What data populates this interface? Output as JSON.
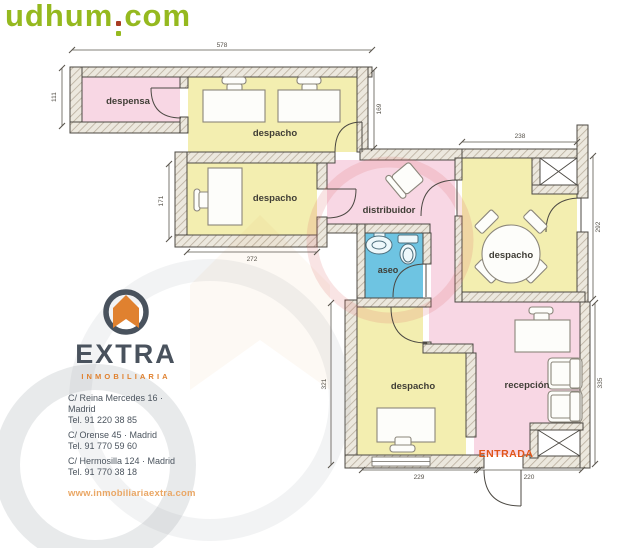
{
  "watermark": {
    "text_main": "udhum",
    "text_tld": "com"
  },
  "floorplan": {
    "rooms": [
      {
        "id": "despensa",
        "label": "despensa"
      },
      {
        "id": "despacho-top",
        "label": "despacho"
      },
      {
        "id": "despacho-mid",
        "label": "despacho"
      },
      {
        "id": "distribuidor",
        "label": "distribuidor"
      },
      {
        "id": "aseo",
        "label": "aseo"
      },
      {
        "id": "despacho-right",
        "label": "despacho"
      },
      {
        "id": "despacho-bottom",
        "label": "despacho"
      },
      {
        "id": "recepcion",
        "label": "recepción"
      }
    ],
    "entrance_label": "ENTRADA",
    "dimensions": {
      "top_width": "578",
      "despensa_height": "111",
      "despacho_top_height": "169",
      "despacho_right_width": "238",
      "despacho_right_height": "292",
      "despacho_mid_height": "171",
      "despacho_mid_width": "272",
      "despacho_bottom_height": "321",
      "recepcion_height": "335",
      "bottom_left_width": "229",
      "bottom_right_width": "220"
    },
    "colors": {
      "room_pink": "#f8d7e4",
      "room_yellow": "#f3eeb0",
      "room_blue": "#6ec4e2",
      "entrance_text": "#e05518",
      "wall_hatch": "#b9ae9d"
    }
  },
  "agency": {
    "name": "EXTRA",
    "tagline": "INMOBILIARIA",
    "offices": [
      {
        "address": "C/ Reina Mercedes 16 · Madrid",
        "phone": "Tel. 91 220 38 85"
      },
      {
        "address": "C/ Orense 45 · Madrid",
        "phone": "Tel. 91 770 59 60"
      },
      {
        "address": "C/ Hermosilla 124 · Madrid",
        "phone": "Tel. 91 770 38 18"
      }
    ],
    "website": "www.inmobiliariaextra.com"
  }
}
